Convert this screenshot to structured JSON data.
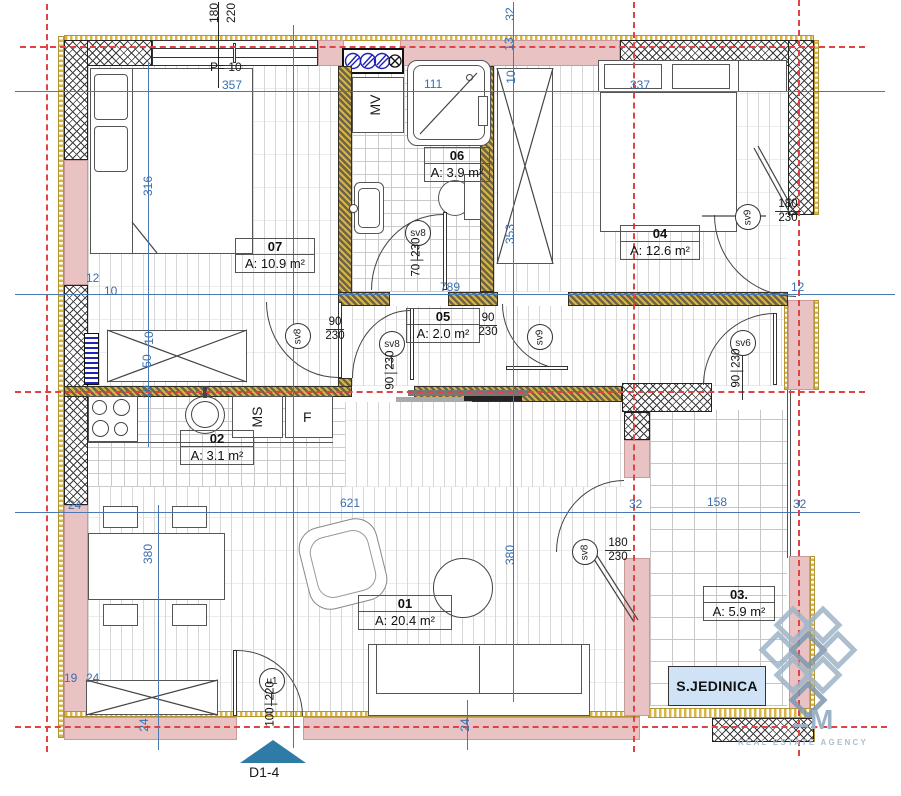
{
  "plan_note": "P= 10",
  "marker": {
    "label": "D1-4"
  },
  "unit": {
    "label": "S.JEDINICA"
  },
  "logo": {
    "letter": "M",
    "tagline": "REAL ESTATE AGENCY"
  },
  "appliances": {
    "washer": "MV",
    "dishwasher": "MS",
    "fridge": "F"
  },
  "rooms": [
    {
      "num": "07",
      "area": "A: 10.9 m²"
    },
    {
      "num": "06",
      "area": "A: 3.9 m²"
    },
    {
      "num": "05",
      "area": "A: 2.0 m²"
    },
    {
      "num": "04",
      "area": "A: 12.6 m²"
    },
    {
      "num": "02",
      "area": "A: 3.1 m²"
    },
    {
      "num": "01",
      "area": "A: 20.4 m²"
    },
    {
      "num": "03.",
      "area": "A: 5.9 m²"
    }
  ],
  "doors": [
    {
      "id": "sv8",
      "w": "70",
      "h": "230"
    },
    {
      "id": "sv8",
      "w": "90",
      "h": "230"
    },
    {
      "id": "sv8",
      "w": "90",
      "h": "230"
    },
    {
      "id": "sv9",
      "w": "90",
      "h": "230"
    },
    {
      "id": "sv9",
      "w": "180",
      "h": "230"
    },
    {
      "id": "sv6",
      "w": "90",
      "h": "230"
    },
    {
      "id": "sv8",
      "w": "180",
      "h": "230"
    },
    {
      "id": "u1",
      "w": "100",
      "h": "220"
    }
  ],
  "window": {
    "w": "180",
    "h": "220"
  },
  "dims": {
    "top_left_width": "357",
    "shower_width": "111",
    "top_right_width": "337",
    "t32": "32",
    "t13": "13",
    "t10": "10",
    "left_height": "316",
    "closet_height": "353",
    "w12": "12",
    "w10": "10",
    "hall_width": "789",
    "e12": "12",
    "c10a": "10",
    "c50": "50",
    "c10b": "10",
    "living_width": "621",
    "b24a": "24",
    "ter32a": "32",
    "ter158": "158",
    "ter32b": "32",
    "living_height": "380",
    "dining_height": "380",
    "b19": "19",
    "b24b": "24",
    "b24c": "24",
    "b24d": "24"
  },
  "colors": {
    "section_red": "#e04343",
    "dim_blue": "#3a6fae",
    "wall_gold": "#d9b545",
    "wall_pink": "#e9c3c3",
    "unit_bg": "#cfe2f6",
    "marker_blue": "#2e7ba8",
    "logo_gray": "#9fb5c7"
  }
}
